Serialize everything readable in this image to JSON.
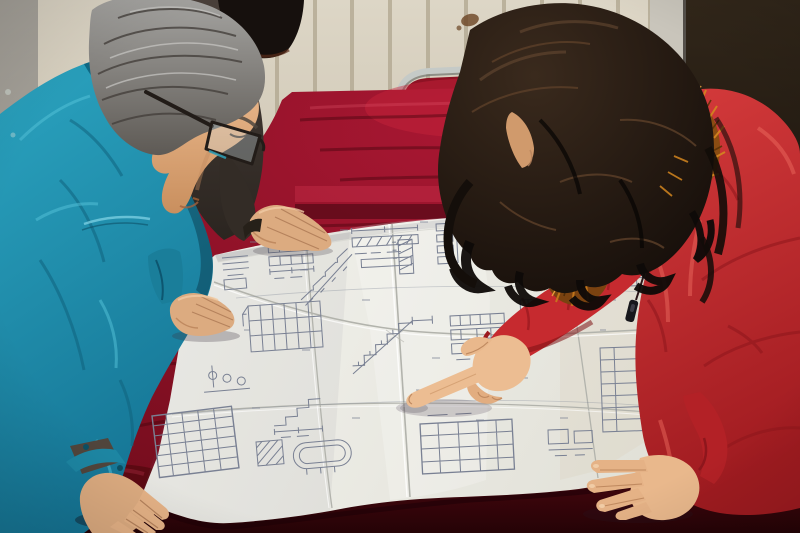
{
  "meta": {
    "description": "Photograph: two workers leaning over a large folded engineering blueprint spread on a table covered with crimson velvet. A gray-haired man in a teal work jacket and dark-rimmed glasses stands at left; a woman in a red quilted parka with an orange fur-trimmed hood and long dark wavy hair stands at right pointing at the drawing with her index finger. A third person in a dark jacket is partially visible behind the man, resting one hand on the far edge of the paper. Background: cream radiator wall with vertical ribs, a light door frame and a dark door at right, and a red chair with a chrome frame behind the table.",
    "people_count": 3
  },
  "scene": {
    "people": [
      {
        "id": "engineer",
        "position": "left",
        "hair": "gray",
        "clothing": "teal work jacket",
        "accessories": "dark rimmed glasses",
        "action": "leaning over blueprint, both hands on table"
      },
      {
        "id": "background-person",
        "position": "behind engineer",
        "hair": "black",
        "clothing": "dark brown jacket",
        "action": "hand resting on far edge of blueprint"
      },
      {
        "id": "woman",
        "position": "right",
        "hair": "long dark brown, wavy",
        "clothing": "red quilted parka with orange fur hood trim",
        "action": "pointing at blueprint with right index finger, left hand on paper"
      }
    ],
    "objects": [
      {
        "id": "blueprint",
        "type": "large folded technical drawing",
        "content": "stair sections, beam details, schedule tables, dimension lines"
      },
      {
        "id": "table",
        "covering": "crimson velvet cloth"
      },
      {
        "id": "chair",
        "type": "red chair with chrome frame",
        "position": "behind table"
      },
      {
        "id": "radiator-wall",
        "appearance": "cream with vertical ribs and a small brown stain"
      },
      {
        "id": "door",
        "appearance": "dark, right edge of frame lit"
      }
    ]
  },
  "palette": {
    "wall_top": "#ddd6c6",
    "wall_bottom": "#c9c1ae",
    "wall_left_top": "#a8a49c",
    "wall_left_bottom": "#8f8b83",
    "wall_stripe": "#b0a68f",
    "wall_stain": "#6b4423",
    "door_top": "#32271a",
    "door_bottom": "#0a0604",
    "door_frame": "#c9c5bb",
    "door_frame_edge": "#55504a",
    "chrome": "#c5cac7",
    "chrome_shadow": "#6f746f",
    "chair_red": "#8e1224",
    "velvet_center": "#a81732",
    "velvet_edge": "#6d0b1a",
    "velvet_front_top": "#4c0710",
    "velvet_front_bottom": "#250306",
    "paper_light": "#f4f4ef",
    "paper_dark": "#e1e0d7",
    "fold": "#b2b3ac",
    "fold_hi": "#ffffff",
    "blueprint_line": "#798093",
    "jacket_light": "#2ba4c0",
    "jacket_dark": "#157595",
    "jacket_collar": "#0f6884",
    "jacket_seam_light": "#7fd2e4",
    "jacket_cuff": "#1d86a3",
    "coat_light": "#d63b3c",
    "coat_dark": "#a01b20",
    "coat_seam": "#8e161c",
    "coat_highlight": "#ef6f62",
    "coat_shadow_line": "#7e1014",
    "sleeve_red": "#c62a2f",
    "sleeve_left_red": "#b32126",
    "fur_base": "#8a4c12",
    "fur2_base": "#7a4210",
    "fur_light": "#d4861f",
    "fur_mid": "#c87a1c",
    "fur_bright": "#f0a93f",
    "fur_dark": "#5a3208",
    "m_hair_light": "#a6a5a2",
    "m_hair_dark": "#5e5a55",
    "m_hair_streak": "#45403c",
    "m_hair_streak_light": "#c9c8c5",
    "w_hair_light": "#3a2a1d",
    "w_hair_dark": "#140d09",
    "w_hair_streak": "#5a3e28",
    "dark_jacket_top": "#4a403a",
    "dark_jacket_bottom": "#2b2520",
    "dark_hair": "#16100d",
    "dark_sleeve": "#332c26",
    "dark_cuff": "#262019",
    "skin_top": "#eab88c",
    "skin_bottom": "#c98f5e",
    "skin_hand": "#dcab80",
    "skin_hand_light": "#ecbd92",
    "skin_woman": "#e9b88c",
    "skin_fingers": "#e5b286",
    "skin_shadow": "#b5825c",
    "skin_line": "#c08a60",
    "skin_face_shadow": "#d09a6c",
    "glasses_frame": "#221c18",
    "glasses_glint": "#2fa0b8",
    "zipper_dark": "#17171c"
  }
}
